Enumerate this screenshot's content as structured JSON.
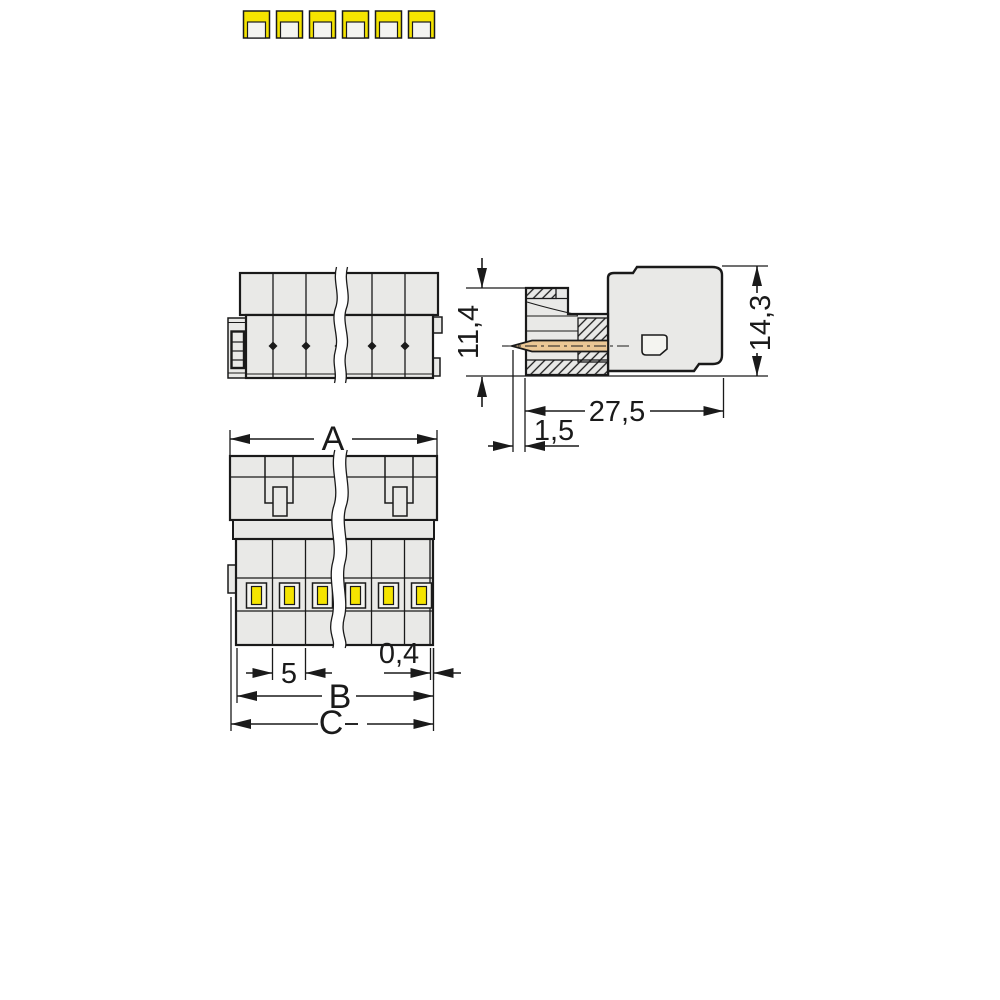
{
  "drawing": {
    "type": "technical-dimension-drawing",
    "subject": "multi-pole plug connector with spring clamp terminals",
    "views": {
      "front": {
        "label": "front view with clamp openings",
        "poles_visible": 6,
        "break_line": true
      },
      "side": {
        "label": "side section view with contact pin",
        "hatched": true
      },
      "top": {
        "label": "top view with latch and pin slots",
        "poles_visible": 6,
        "break_line": true
      }
    },
    "dimensions": {
      "overall_width": "A",
      "body_width": "B",
      "total_width": "C",
      "pin_pitch": "5",
      "wall_thickness": "0,4",
      "front_height": "11,4",
      "total_height": "14,3",
      "body_length": "27,5",
      "pin_tip_offset": "1,5"
    },
    "colors": {
      "background": "#ffffff",
      "body": "#e9e9e7",
      "inner": "#f4f4f0",
      "yellow": "#f5e400",
      "tan": "#ebc795",
      "line": "#1a1a1a"
    }
  }
}
